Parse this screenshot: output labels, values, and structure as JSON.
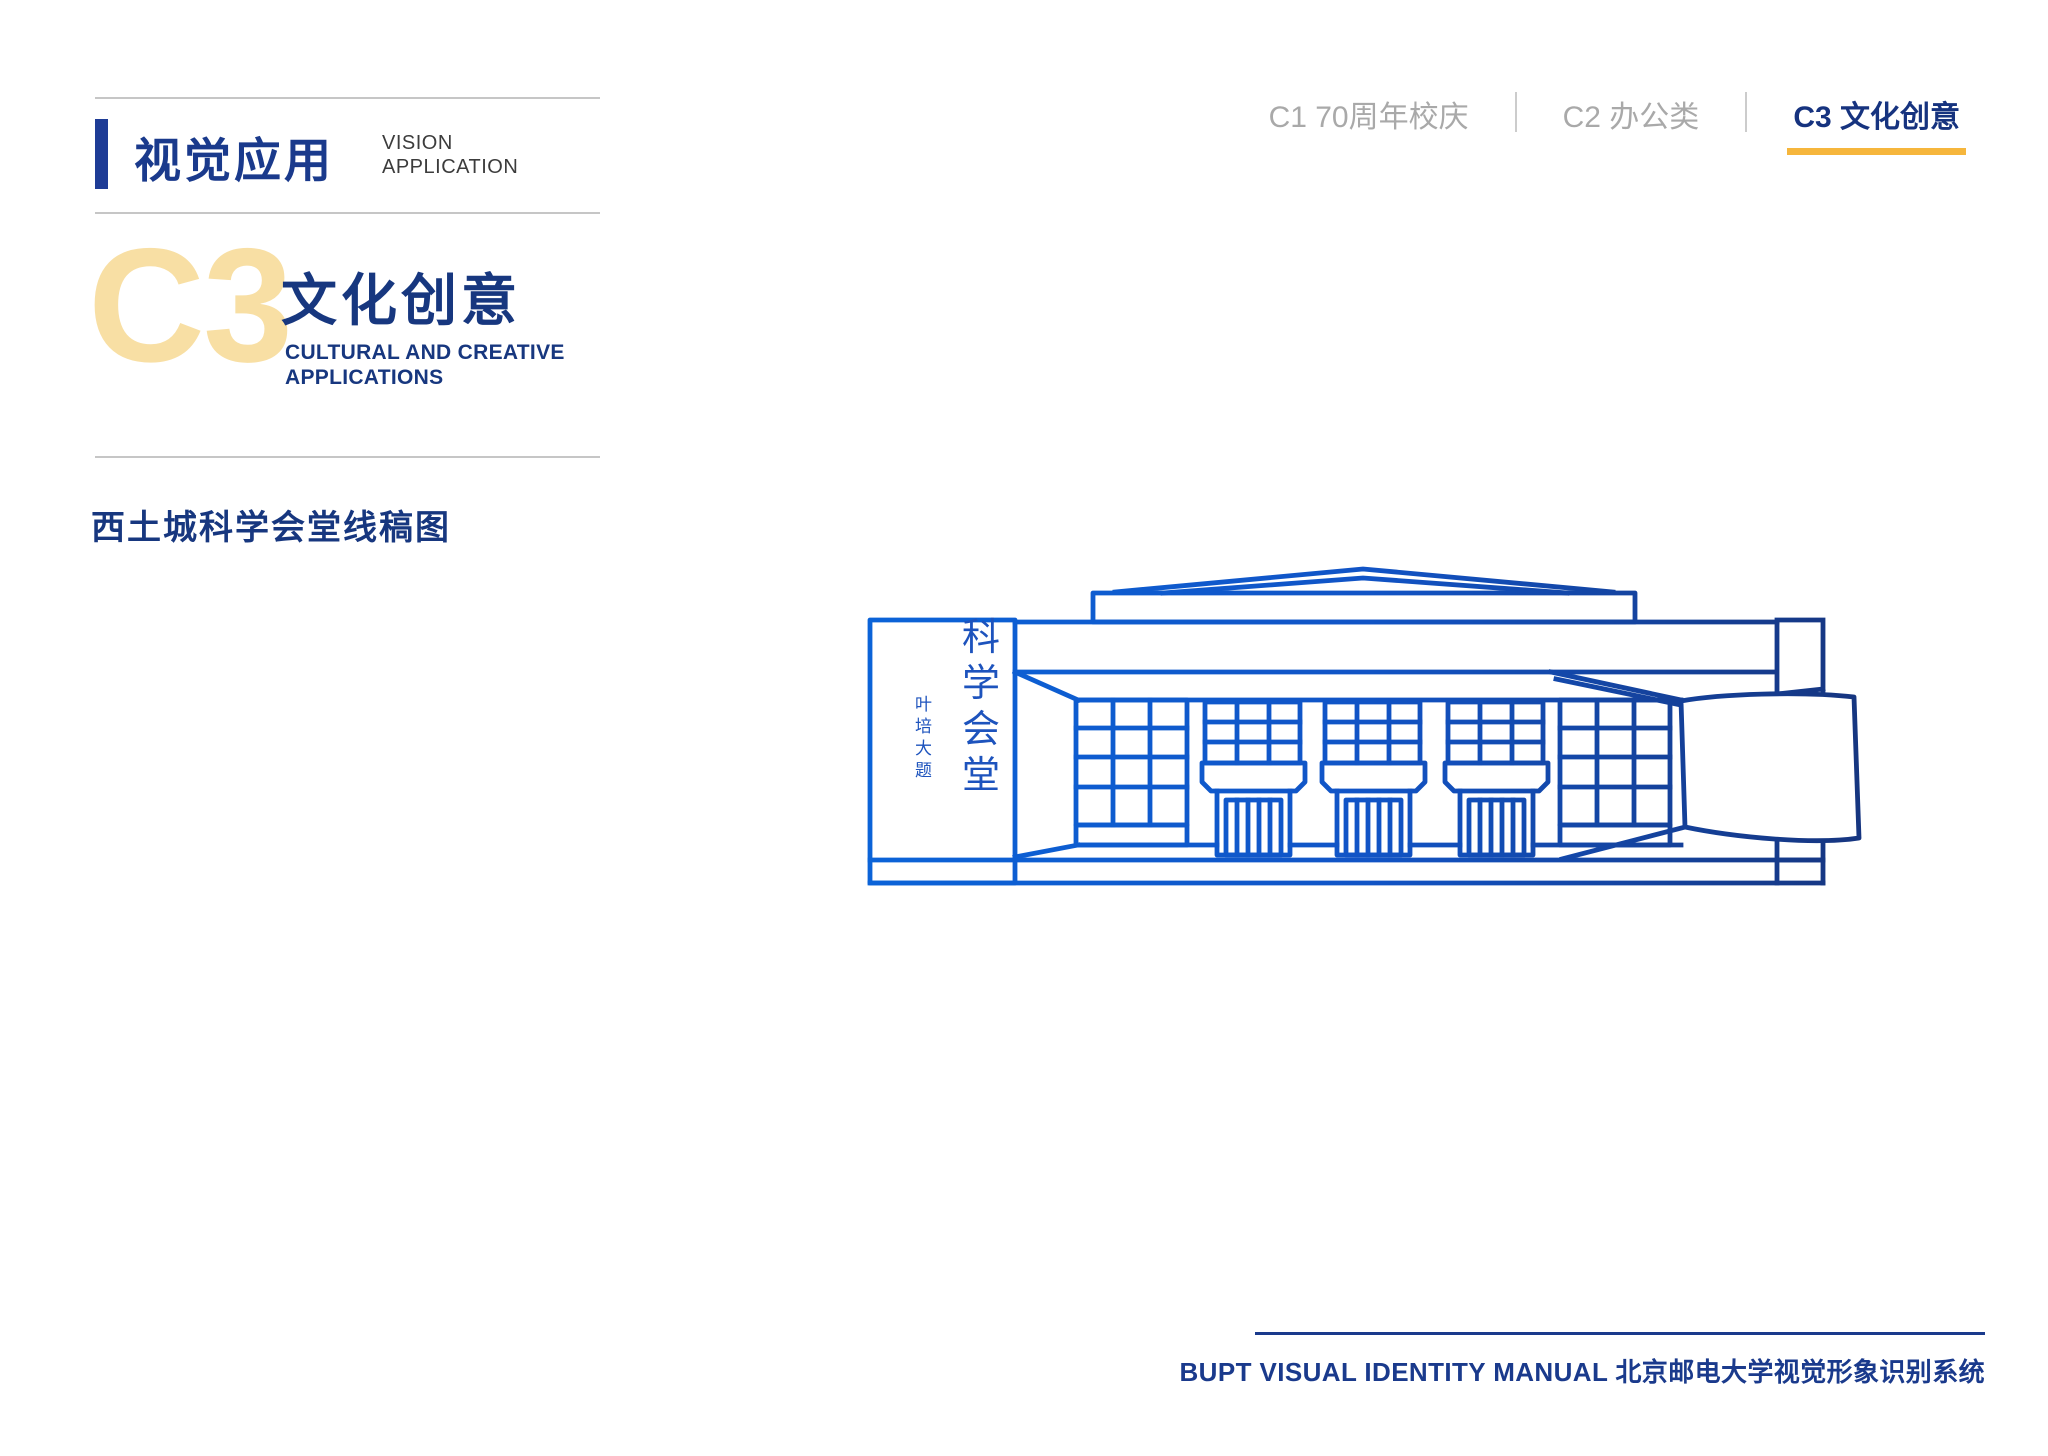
{
  "header": {
    "section_title_zh": "视觉应用",
    "section_title_en_line1": "VISION",
    "section_title_en_line2": "APPLICATION"
  },
  "nav": {
    "tabs": [
      {
        "label": "C1  70周年校庆",
        "active": false
      },
      {
        "label": "C2  办公类",
        "active": false
      },
      {
        "label": "C3  文化创意",
        "active": true
      }
    ]
  },
  "section": {
    "code": "C3",
    "title_zh": "文化创意",
    "title_en_line1": "CULTURAL AND CREATIVE",
    "title_en_line2": "APPLICATIONS"
  },
  "content": {
    "heading": "西土城科学会堂线稿图",
    "drawing": {
      "description": "科学会堂线稿图",
      "calligraphy_vertical": "科学会堂",
      "signature_vertical": "叶培大题"
    }
  },
  "footer": {
    "text": "BUPT VISUAL IDENTITY MANUAL 北京邮电大学视觉形象识别系统"
  },
  "colors": {
    "navy": "#17377F",
    "navy_text": "#1A3A8C",
    "accent_bar": "#1E3C96",
    "gold_light": "#F8DFA4",
    "gold_underline": "#F6B63C",
    "gray_tab": "#A9A9A9",
    "line_blue_left": "#0B63D8",
    "line_blue_right": "#16357F",
    "calligraphy_blue": "#1d53bd"
  }
}
